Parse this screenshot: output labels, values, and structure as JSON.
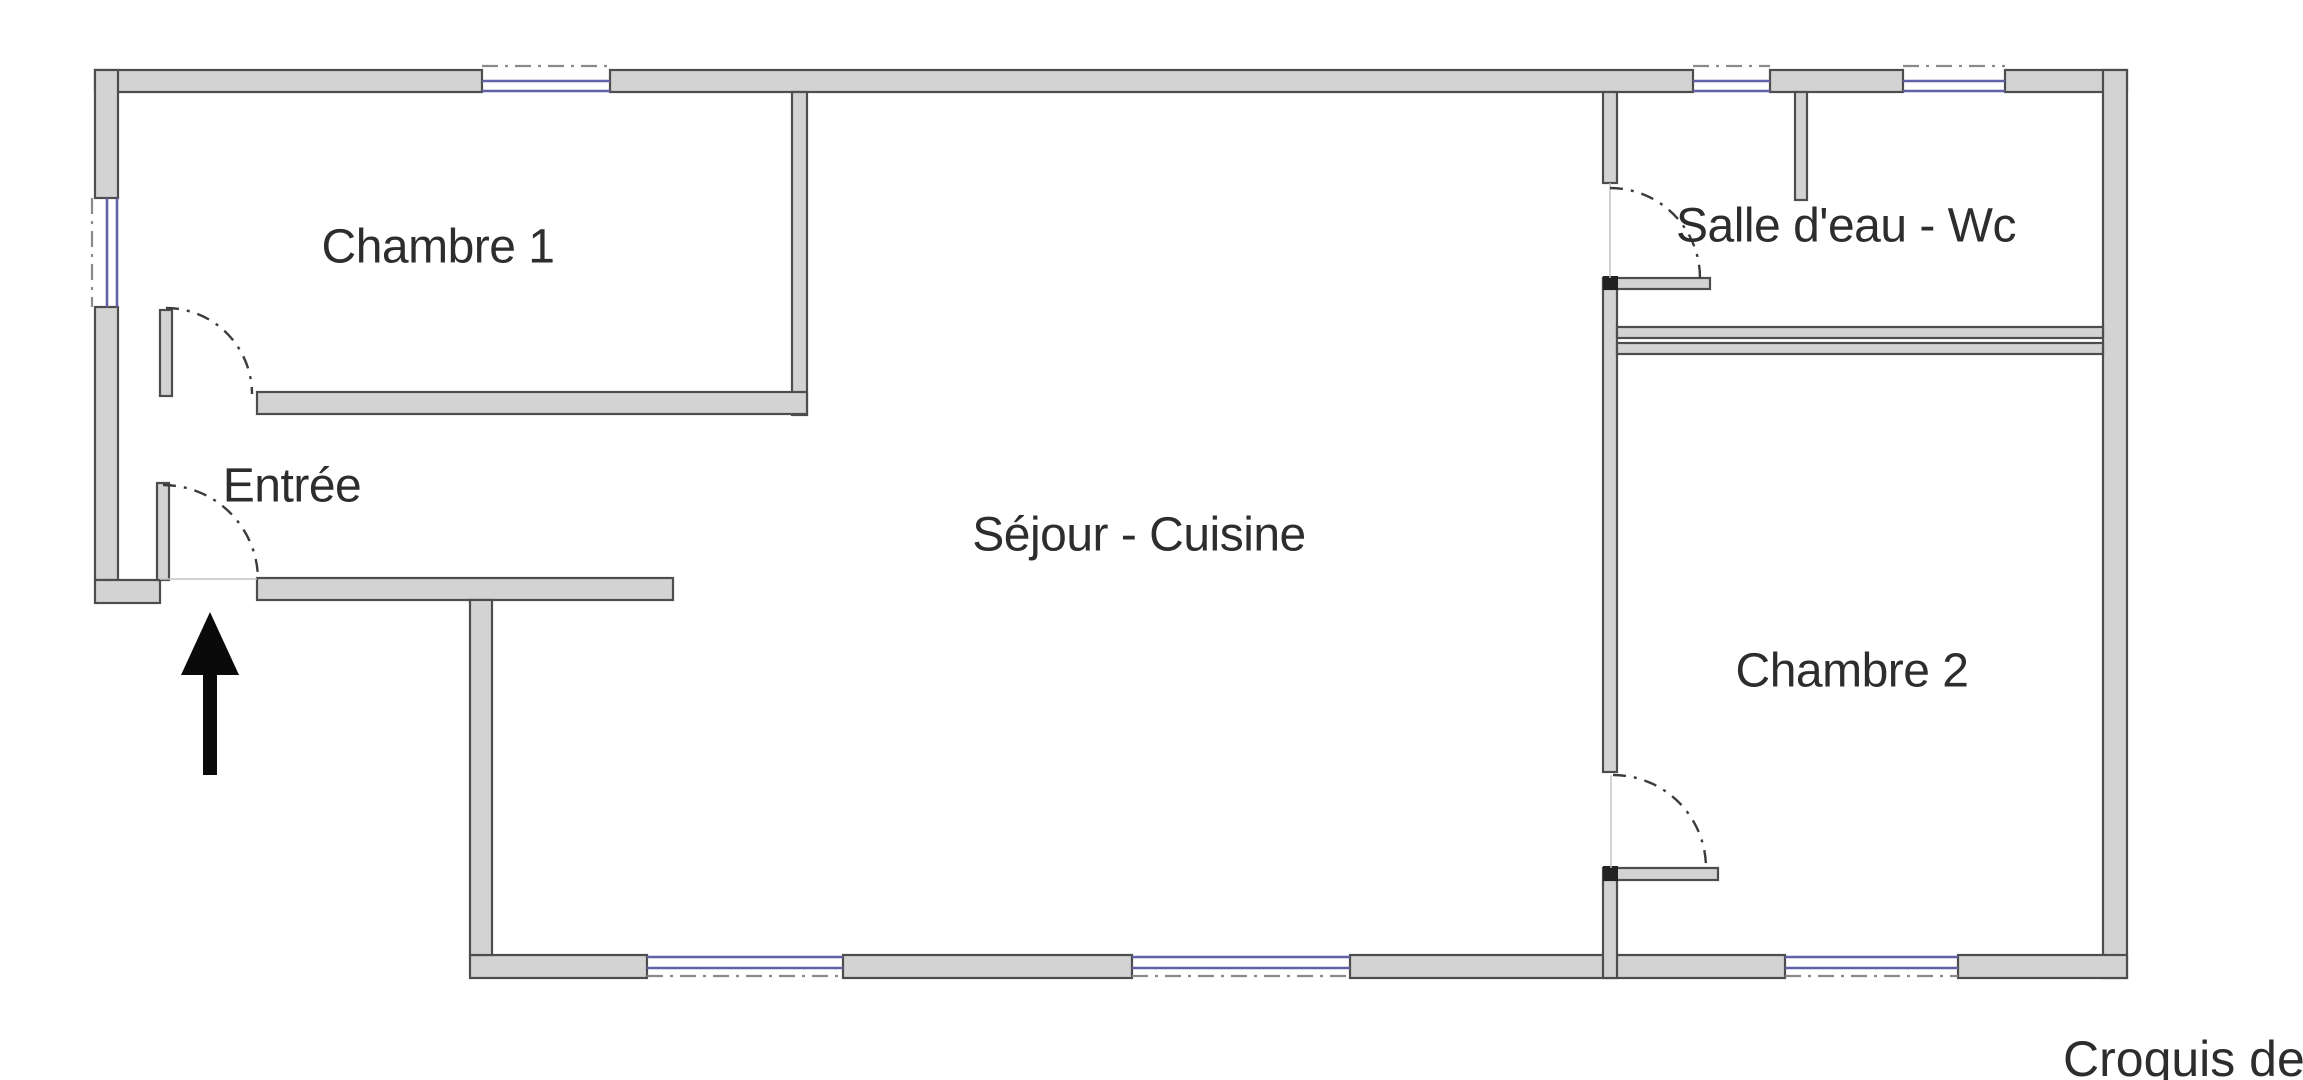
{
  "caption": {
    "text": "Croquis de si",
    "x": 2063,
    "y": 1030
  },
  "rooms": [
    {
      "id": "chambre-1",
      "label": "Chambre 1",
      "cx": 438,
      "cy": 247
    },
    {
      "id": "entree",
      "label": "Entrée",
      "cx": 292,
      "cy": 486
    },
    {
      "id": "sejour-cuisine",
      "label": "Séjour - Cuisine",
      "cx": 1139,
      "cy": 535
    },
    {
      "id": "salle-eau-wc",
      "label": "Salle d'eau - Wc",
      "cx": 1846,
      "cy": 226
    },
    {
      "id": "chambre-2",
      "label": "Chambre 2",
      "cx": 1852,
      "cy": 671
    }
  ],
  "colors": {
    "wall_fill": "#d3d3d3",
    "wall_stroke": "#4d4d4d",
    "window_blue": "#6161a8",
    "dash_gray": "#8a8a8a",
    "thin_gray": "#c4c4c4",
    "cap_dark": "#222222",
    "arrow_black": "#0a0a0a"
  },
  "plan": {
    "walls": [
      {
        "name": "wall-top-a",
        "x": 95,
        "y": 70,
        "w": 387,
        "h": 22
      },
      {
        "name": "wall-top-b",
        "x": 610,
        "y": 70,
        "w": 1083,
        "h": 22
      },
      {
        "name": "wall-top-c",
        "x": 1770,
        "y": 70,
        "w": 133,
        "h": 22
      },
      {
        "name": "wall-top-d",
        "x": 2005,
        "y": 70,
        "w": 122,
        "h": 22
      },
      {
        "name": "wall-left-upper",
        "x": 95,
        "y": 70,
        "w": 23,
        "h": 128
      },
      {
        "name": "wall-left-lower",
        "x": 95,
        "y": 307,
        "w": 23,
        "h": 273
      },
      {
        "name": "wall-left-foot",
        "x": 95,
        "y": 580,
        "w": 65,
        "h": 23
      },
      {
        "name": "wall-right",
        "x": 2103,
        "y": 70,
        "w": 24,
        "h": 908
      },
      {
        "name": "wall-south-a",
        "x": 470,
        "y": 955,
        "w": 177,
        "h": 23
      },
      {
        "name": "wall-south-b",
        "x": 843,
        "y": 955,
        "w": 289,
        "h": 23
      },
      {
        "name": "wall-south-c",
        "x": 1350,
        "y": 955,
        "w": 435,
        "h": 23
      },
      {
        "name": "wall-south-d",
        "x": 1958,
        "y": 955,
        "w": 169,
        "h": 23
      },
      {
        "name": "wall-entree-south",
        "x": 257,
        "y": 578,
        "w": 416,
        "h": 22
      },
      {
        "name": "wall-step",
        "x": 470,
        "y": 600,
        "w": 22,
        "h": 355
      },
      {
        "name": "wall-chambre1-right",
        "x": 792,
        "y": 92,
        "w": 15,
        "h": 323
      },
      {
        "name": "wall-chambre1-bottom",
        "x": 257,
        "y": 392,
        "w": 550,
        "h": 22
      },
      {
        "name": "door-leaf-chambre1",
        "x": 160,
        "y": 310,
        "w": 12,
        "h": 86
      },
      {
        "name": "door-leaf-entree",
        "x": 157,
        "y": 483,
        "w": 12,
        "h": 97
      },
      {
        "name": "wall-divider-upper",
        "x": 1603,
        "y": 92,
        "w": 14,
        "h": 91
      },
      {
        "name": "wall-divider-middle",
        "x": 1603,
        "y": 278,
        "w": 14,
        "h": 494
      },
      {
        "name": "wall-divider-lower",
        "x": 1603,
        "y": 868,
        "w": 14,
        "h": 110
      },
      {
        "name": "wall-sde-doorstop",
        "x": 1603,
        "y": 278,
        "w": 107,
        "h": 11
      },
      {
        "name": "wall-ch2-doorstop",
        "x": 1605,
        "y": 868,
        "w": 113,
        "h": 12
      },
      {
        "name": "wall-sde-bottom",
        "x": 1617,
        "y": 327,
        "w": 486,
        "h": 11
      },
      {
        "name": "wall-ch2-top",
        "x": 1617,
        "y": 343,
        "w": 486,
        "h": 11
      },
      {
        "name": "wall-sde-stub",
        "x": 1795,
        "y": 92,
        "w": 12,
        "h": 108
      }
    ],
    "caps": [
      {
        "name": "cap-sde-doorstop",
        "x": 1603,
        "y": 276,
        "w": 15,
        "h": 14
      },
      {
        "name": "cap-ch2-doorstop",
        "x": 1603,
        "y": 866,
        "w": 15,
        "h": 15
      }
    ],
    "window_lines": [
      {
        "name": "window-top-1",
        "x1": 482,
        "y1": 81,
        "x2": 610,
        "y2": 81
      },
      {
        "name": "window-top-1",
        "x1": 482,
        "y1": 91,
        "x2": 610,
        "y2": 91
      },
      {
        "name": "window-top-2",
        "x1": 1693,
        "y1": 81,
        "x2": 1770,
        "y2": 81
      },
      {
        "name": "window-top-2",
        "x1": 1693,
        "y1": 91,
        "x2": 1770,
        "y2": 91
      },
      {
        "name": "window-top-3",
        "x1": 1903,
        "y1": 81,
        "x2": 2005,
        "y2": 81
      },
      {
        "name": "window-top-3",
        "x1": 1903,
        "y1": 91,
        "x2": 2005,
        "y2": 91
      },
      {
        "name": "window-left",
        "x1": 107,
        "y1": 198,
        "x2": 107,
        "y2": 307
      },
      {
        "name": "window-left",
        "x1": 117,
        "y1": 198,
        "x2": 117,
        "y2": 307
      },
      {
        "name": "window-south-a",
        "x1": 647,
        "y1": 957,
        "x2": 843,
        "y2": 957
      },
      {
        "name": "window-south-a",
        "x1": 647,
        "y1": 968,
        "x2": 843,
        "y2": 968
      },
      {
        "name": "window-south-b",
        "x1": 1132,
        "y1": 957,
        "x2": 1350,
        "y2": 957
      },
      {
        "name": "window-south-b",
        "x1": 1132,
        "y1": 968,
        "x2": 1350,
        "y2": 968
      },
      {
        "name": "window-south-c",
        "x1": 1785,
        "y1": 957,
        "x2": 1958,
        "y2": 957
      },
      {
        "name": "window-south-c",
        "x1": 1785,
        "y1": 968,
        "x2": 1958,
        "y2": 968
      }
    ],
    "dash_lines": [
      {
        "name": "window-axis-top-1",
        "x1": 482,
        "y1": 66,
        "x2": 610,
        "y2": 66
      },
      {
        "name": "window-axis-top-2",
        "x1": 1693,
        "y1": 66,
        "x2": 1770,
        "y2": 66
      },
      {
        "name": "window-axis-top-3",
        "x1": 1903,
        "y1": 66,
        "x2": 2005,
        "y2": 66
      },
      {
        "name": "window-axis-left",
        "x1": 92,
        "y1": 198,
        "x2": 92,
        "y2": 307
      },
      {
        "name": "window-axis-south-a",
        "x1": 647,
        "y1": 976,
        "x2": 843,
        "y2": 976
      },
      {
        "name": "window-axis-south-b",
        "x1": 1132,
        "y1": 976,
        "x2": 1350,
        "y2": 976
      },
      {
        "name": "window-axis-south-c",
        "x1": 1785,
        "y1": 976,
        "x2": 1958,
        "y2": 976
      }
    ],
    "thin_lines": [
      {
        "name": "threshold-entree",
        "x1": 160,
        "y1": 579,
        "x2": 257,
        "y2": 579
      },
      {
        "name": "door-axis-salle-eau",
        "x1": 1610,
        "y1": 183,
        "x2": 1610,
        "y2": 278
      },
      {
        "name": "door-axis-chambre2",
        "x1": 1611,
        "y1": 775,
        "x2": 1611,
        "y2": 868
      }
    ],
    "door_arcs": [
      {
        "name": "door-arc-chambre1",
        "d": "M 166 308 A 86 86 0 0 1 252 394"
      },
      {
        "name": "door-arc-entree",
        "d": "M 163 485 A 95 95 0 0 1 258 580"
      },
      {
        "name": "door-arc-salle-eau",
        "d": "M 1610 188 A 90 90 0 0 1 1700 278"
      },
      {
        "name": "door-arc-chambre2",
        "d": "M 1613 775 A 93 93 0 0 1 1706 868"
      }
    ],
    "arrow": {
      "head_points": "210,612 181,675 239,675",
      "shaft": {
        "x": 203,
        "y": 673,
        "w": 14,
        "h": 102
      }
    }
  }
}
